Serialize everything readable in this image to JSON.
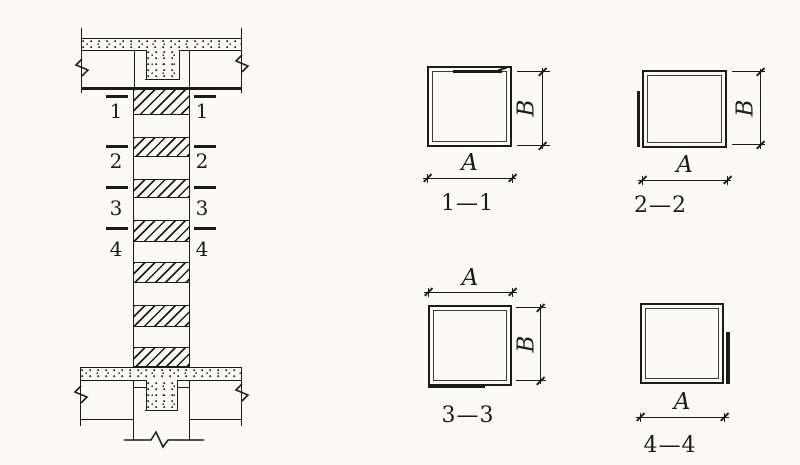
{
  "colors": {
    "ink": "#1b1b1b",
    "paper": "#fbfaf7"
  },
  "elevation": {
    "section_marks": [
      {
        "number": "1"
      },
      {
        "number": "2"
      },
      {
        "number": "3"
      },
      {
        "number": "4"
      }
    ]
  },
  "sections": [
    {
      "label": "1—1",
      "width_letter": "A",
      "height_letter": "B",
      "lap_side": "top"
    },
    {
      "label": "2—2",
      "width_letter": "A",
      "height_letter": "B",
      "lap_side": "left"
    },
    {
      "label": "3—3",
      "width_letter": "A",
      "height_letter": "B",
      "lap_side": "bottom"
    },
    {
      "label": "4—4",
      "width_letter": "A",
      "lap_side": "right"
    }
  ]
}
